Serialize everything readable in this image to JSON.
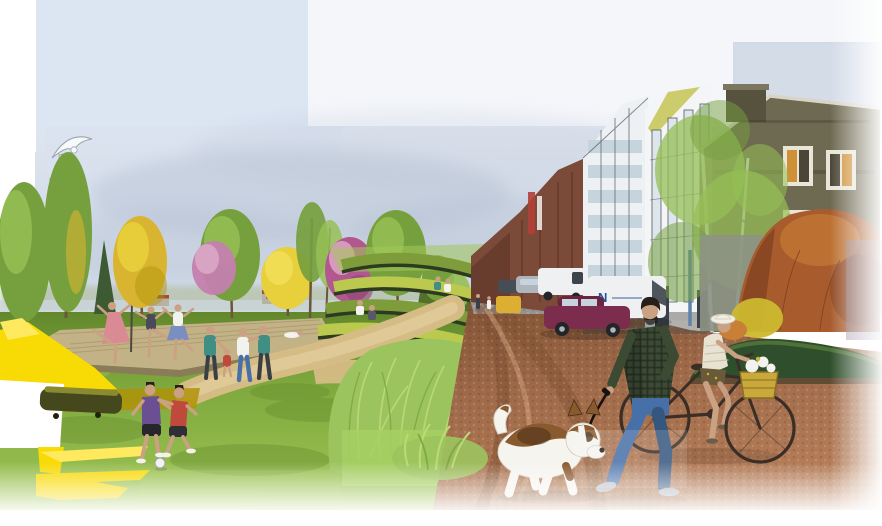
{
  "street": {
    "van_logo": "N"
  },
  "objects": [
    "sky-collage",
    "seagull",
    "tree-line",
    "ballet-dancers",
    "dancing-couple",
    "children-playing-football",
    "amphitheater-terraces",
    "meadow-lawn",
    "yellow-paint-splashes",
    "dirt-path",
    "ornamental-grass",
    "cobbled-street",
    "parked-cars",
    "warehouse-facades",
    "autumn-shrubs",
    "birch-trees",
    "man-walking-dog",
    "dog-on-leash",
    "woman-cycling"
  ],
  "palette": {
    "pageBg": "#ffffff",
    "skyA": "#dce5f2",
    "skyB": "#eef2f8",
    "skyC": "#c9d3e2",
    "skyTop": "#f4f6fa",
    "cloud": "#b9c4d4",
    "seagullBody": "#f7f8fa",
    "seagullShade": "#9aa4b0",
    "distantWater": "#ccd6dc",
    "distantTree": "#b4c0a4",
    "shedWall": "#b8b2a4",
    "shedRoof": "#a24e2e",
    "treeGreen": "#76a03e",
    "treeGreenLight": "#96bf55",
    "treeDark": "#3d5a33",
    "treeYellow": "#d9b430",
    "treeYellowBright": "#e8cf3c",
    "treeYellowPale": "#f2de55",
    "blossomPink": "#c47fae",
    "blossomPinkLight": "#dca6c6",
    "blossomMagenta": "#b2578f",
    "blossomMagentaDark": "#8e4474",
    "trunk": "#6b5638",
    "deckTan": "#c3b285",
    "deckEdge": "#9b8c64",
    "deckFace": "#8a7c58",
    "lawn": "#7fa93e",
    "lawnDark": "#62882c",
    "lawnLight": "#a3c957",
    "lawnFlat": "#a6d063",
    "splashYellow": "#f8da05",
    "splashYellowLight": "#ffe95e",
    "splashOlive": "#b09208",
    "benchDark": "#45481c",
    "benchLight": "#8a8a30",
    "pathSand": "#d5bc85",
    "pathSandLight": "#e2cf9e",
    "stepDark": "#2c3a20",
    "stepGreen": "#7e9c3a",
    "stepLime": "#bcc94f",
    "hedgeSlope": "#54702c",
    "grassTall": "#9cc45e",
    "grassTallLight": "#bada78",
    "grassTallDark": "#7ea943",
    "roadDirt": "#a06b4a",
    "roadDirtDark": "#815234",
    "roadDistant": "#9aa3a6",
    "cobble": "#b9805a",
    "cobbleDark": "#96603f",
    "cobbleLight": "#d2a47c",
    "brickFar": "#7c4a38",
    "brickDark": "#5e3526",
    "banner": "#b24038",
    "facadeWhite": "#eef1f4",
    "facadeWhite2": "#f4f5f6",
    "windowBlue": "#c6d4de",
    "windowPale": "#dde6ec",
    "mullion": "#565b60",
    "roofOlive": "#c2c24a",
    "bldgOlive": "#6e6951",
    "bldgOliveDark": "#57523e",
    "bldgOliveLight": "#7c7660",
    "roofEdge": "#d8d5c8",
    "winFrame": "#e9e6d8",
    "winGlow": "#cf9138",
    "winDark": "#4a4536",
    "doorDark": "#3c4147",
    "bluePole": "#5f83ab",
    "benchWood": "#6b5d4a",
    "birchTrunk": "#cfd3cf",
    "birchDash": "#5a5f5a",
    "shrubRust": "#a85c2e",
    "shrubRustDark": "#7e3f1f",
    "shrubOrange": "#c97f35",
    "bushYellow": "#ccb92f",
    "wallGray": "#8d9385",
    "moundGreen": "#2f4f2c",
    "moundGreenLight": "#55793a",
    "roadEdgeDark": "#6b4a35",
    "skin": "#caa183",
    "hairDark": "#272019",
    "plaid": "#3c4a34",
    "plaidDark": "#232d20",
    "teeGray": "#9aa2a8",
    "jeans": "#4870a8",
    "jeansDark": "#35567f",
    "shoeGray": "#b6bac0",
    "leash": "#17120e",
    "dogWhite": "#f6f4ef",
    "dogBrown": "#8a5a2f",
    "dogDark": "#4a2f18",
    "dogOutline": "#d8d2c6",
    "hatWhite": "#f2efe6",
    "hatShade": "#d8d2c2",
    "topCream": "#e8e2d2",
    "topStripe": "#c9c2ae",
    "shortsDark": "#6b5a3a",
    "bikeFrame": "#3a2e26",
    "basketYellow": "#c9a93c",
    "basketEdge": "#8a6d20",
    "maroonCar": "#7c2c4c",
    "maroonCabin": "#6b2542",
    "vanWhite": "#eef0f2",
    "vanBlue": "#2a4f9e",
    "carSilver": "#aeb6bc",
    "carDark": "#474d54",
    "vanYellow": "#dcae32",
    "tyre": "#232528",
    "teal": "#3f8f85",
    "whiteCloth": "#f2f2ee",
    "redShirt": "#bf4a3c",
    "purpleShirt": "#6a4f93",
    "violetPatch": "#8a8194"
  }
}
